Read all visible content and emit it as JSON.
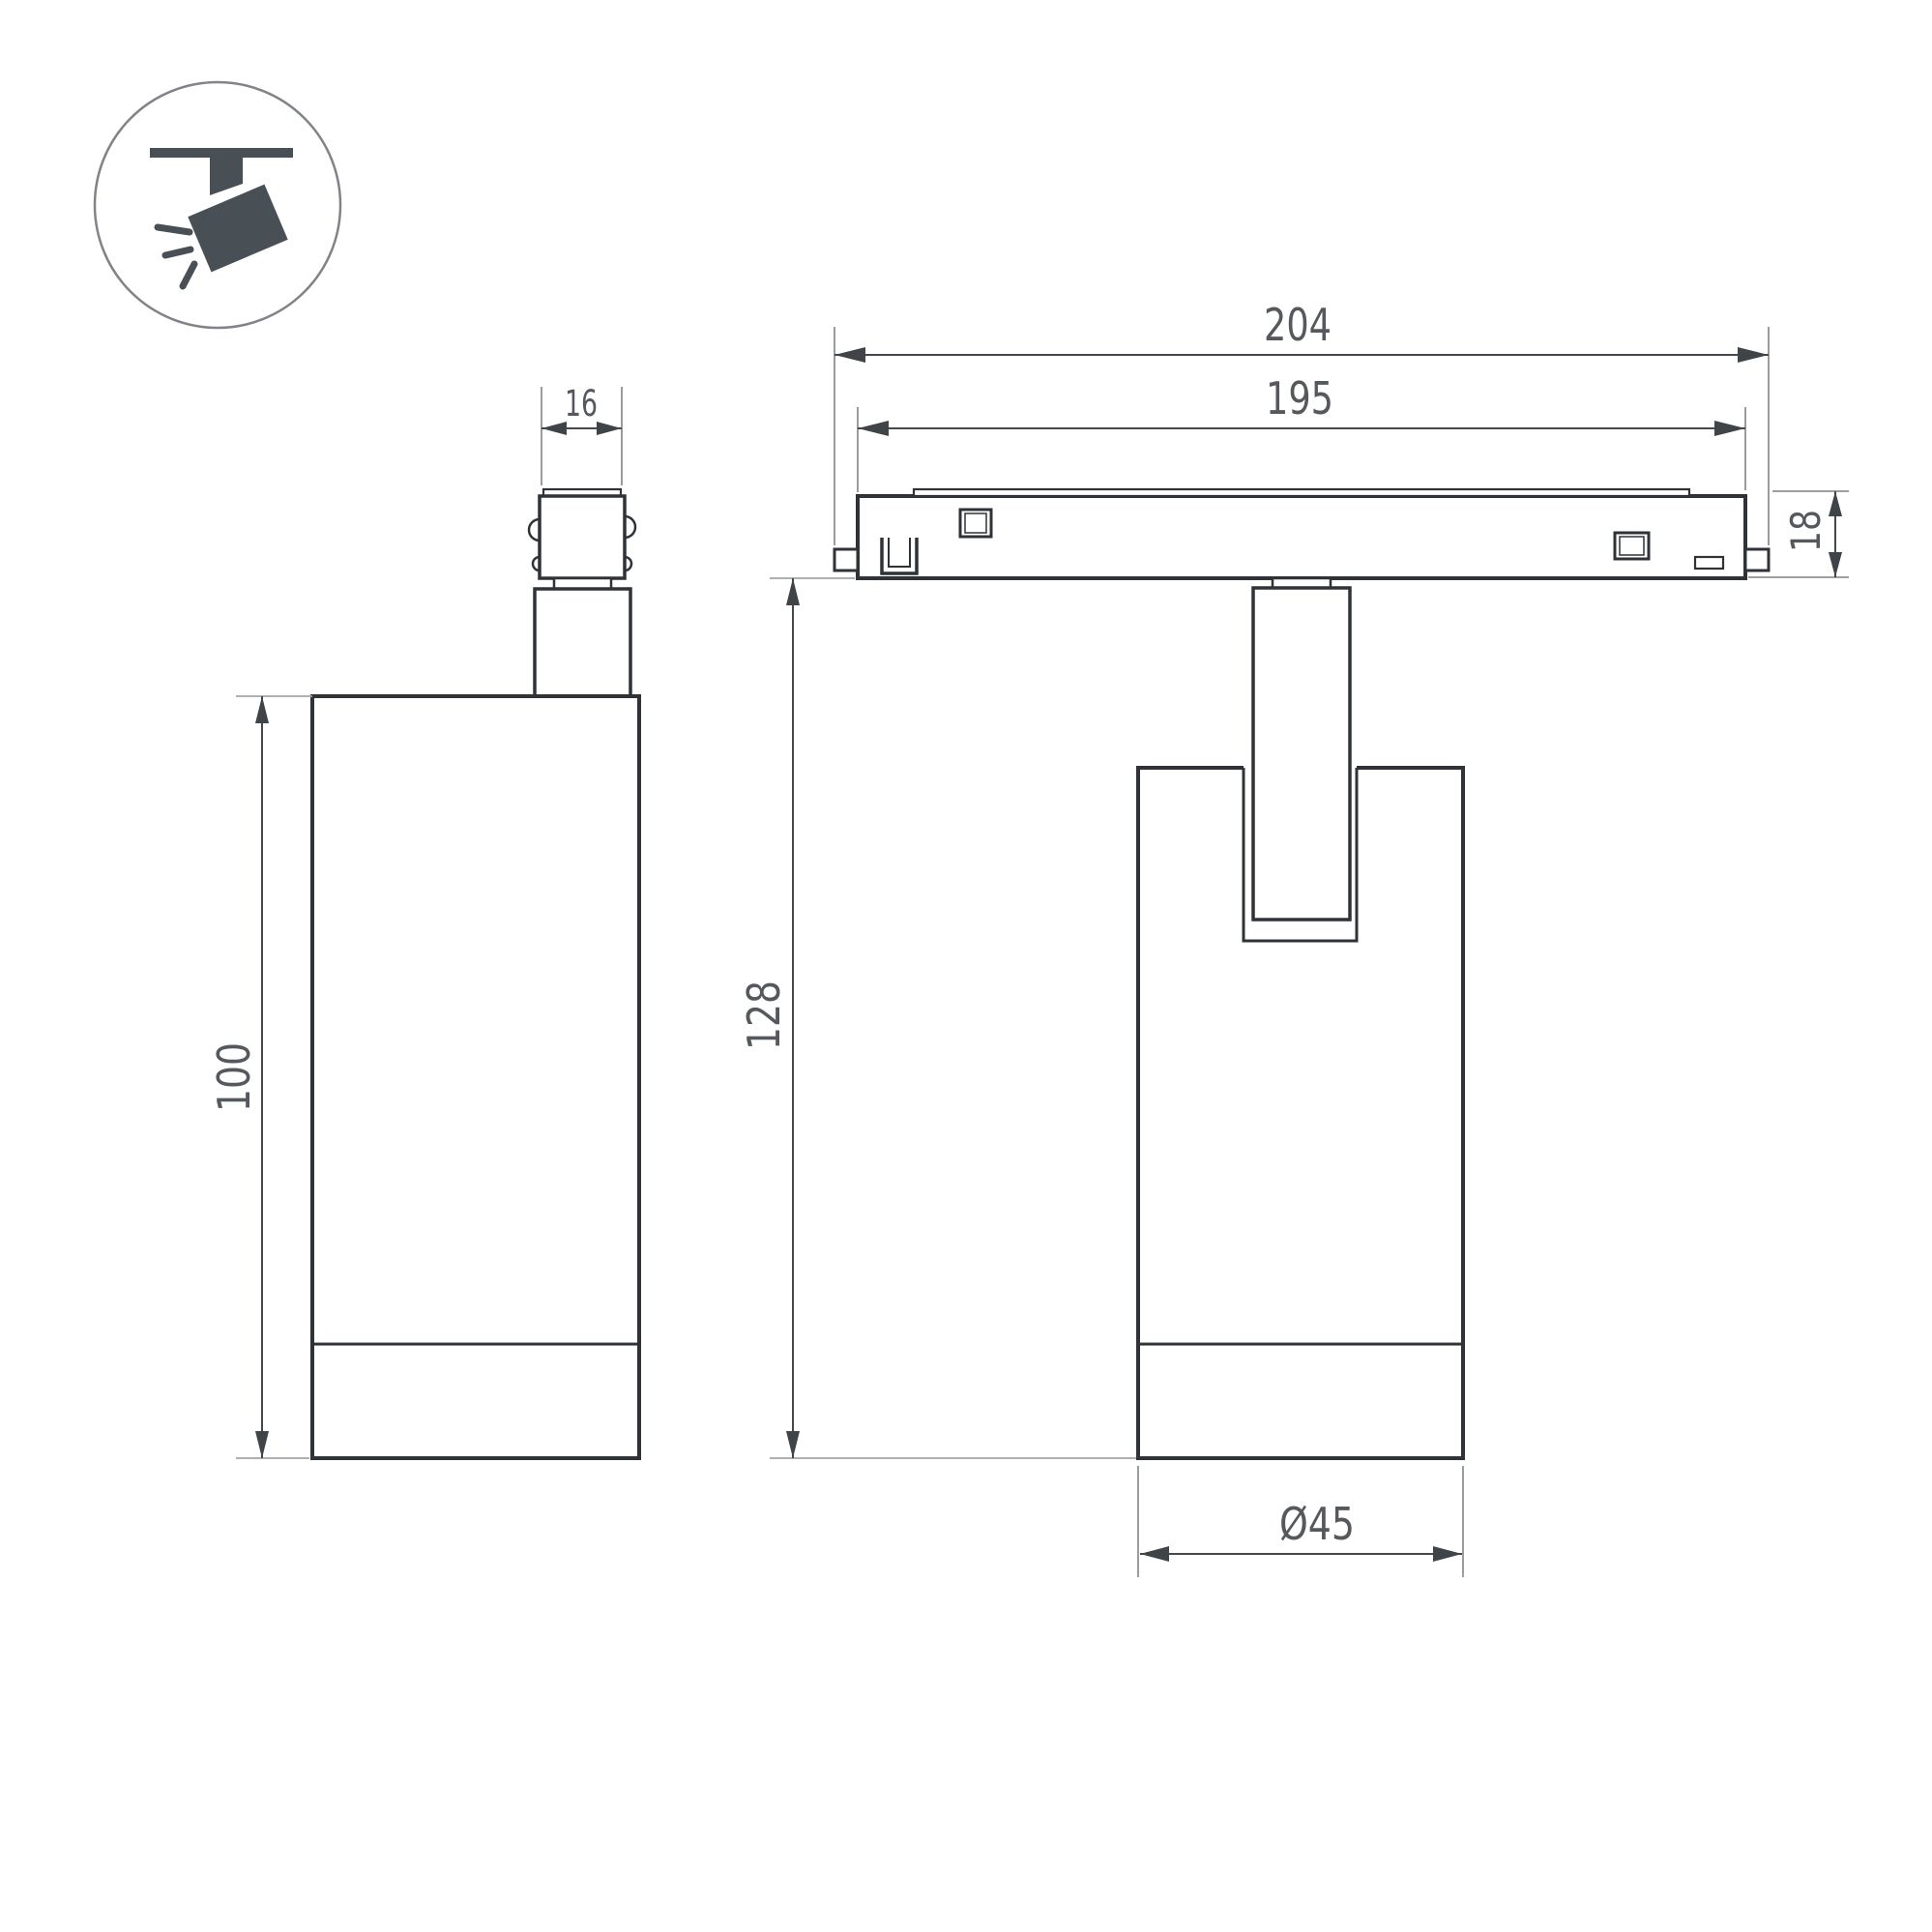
{
  "drawing": {
    "type": "technical-dimension-drawing",
    "subject": "magnetic track spotlight luminaire",
    "background": "#ffffff",
    "colors": {
      "outline": "#2f3337",
      "dimension_line": "#45494d",
      "extension_line": "#8f9294",
      "label_text": "#55585c",
      "icon": "#495055",
      "icon_circle_stroke": "#808488"
    },
    "icon": {
      "name": "track-spotlight-pictogram",
      "description": "angled spotlight hanging from ceiling track with light rays"
    },
    "dimensions": {
      "connector_width": "16",
      "body_height": "100",
      "overall_length": "204",
      "rail_length": "195",
      "rail_height": "18",
      "fixture_height": "128",
      "body_diameter": "Ø45"
    }
  }
}
